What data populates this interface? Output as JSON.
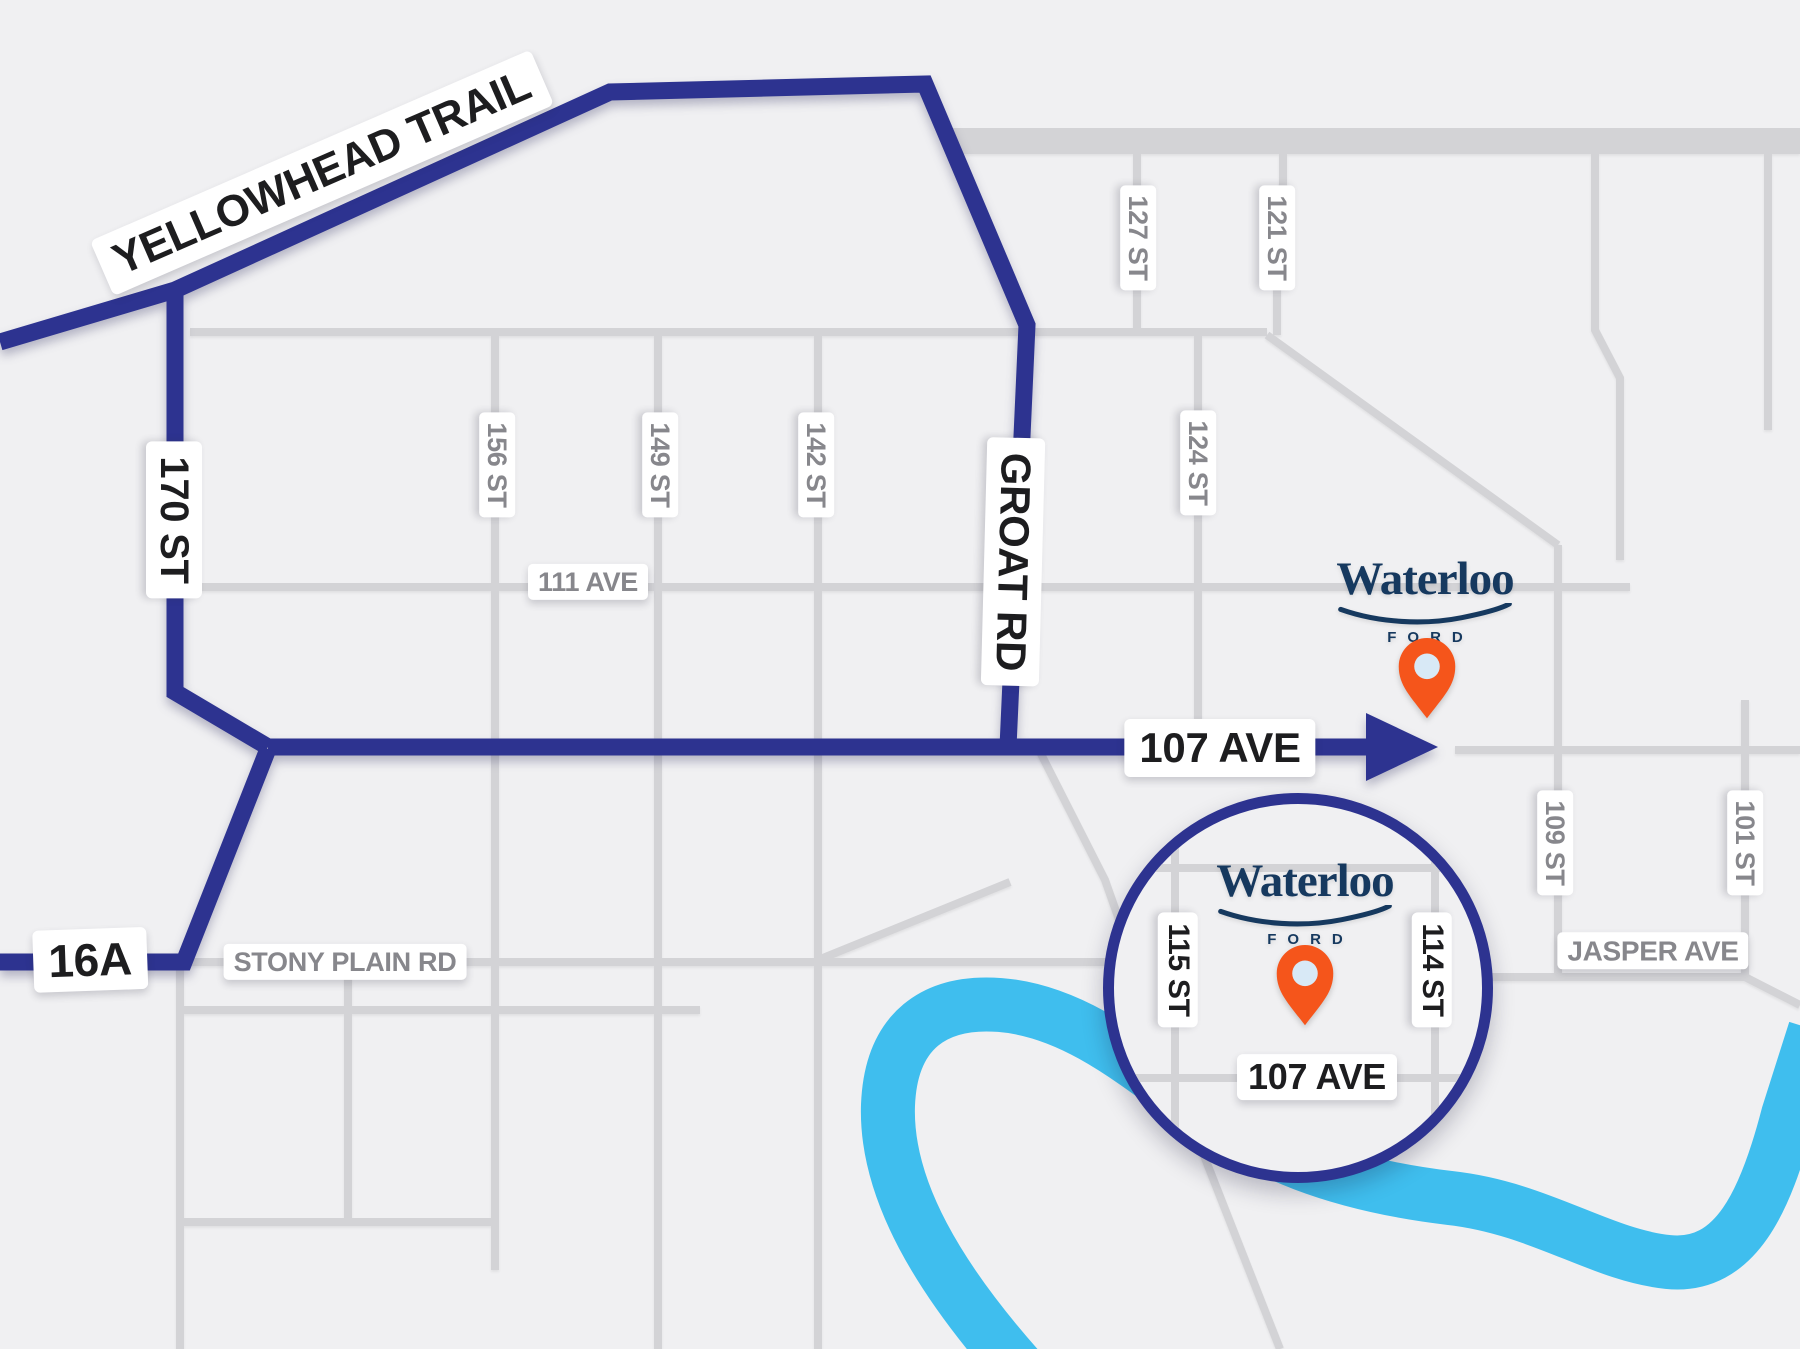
{
  "map_title": "Waterloo Ford location map",
  "roads": {
    "yellowhead_trail": "YELLOWHEAD TRAIL",
    "st_170": "170 ST",
    "groat_rd": "GROAT RD",
    "ave_107": "107 AVE",
    "hwy_16a": "16A",
    "stony_plain_rd": "STONY PLAIN RD",
    "ave_111": "111 AVE",
    "st_156": "156 ST",
    "st_149": "149 ST",
    "st_142": "142 ST",
    "st_127": "127 ST",
    "st_124": "124 ST",
    "st_121": "121 ST",
    "st_109": "109 ST",
    "st_101": "101 ST",
    "jasper_ave": "JASPER AVE"
  },
  "inset": {
    "st_115": "115 ST",
    "st_114": "114 ST",
    "ave_107": "107 AVE"
  },
  "logo": {
    "name": "Waterloo",
    "division": "FORD"
  },
  "icons": {
    "destination_pin": "map-pin-icon",
    "logo_swoosh": "swoosh-underline-icon",
    "route_arrow": "arrow-right-icon"
  },
  "colors": {
    "background": "#f0f0f2",
    "road_gray": "#d3d3d6",
    "route_navy": "#2d3390",
    "river_blue": "#3fbeee",
    "label_gray": "#87878c",
    "label_black": "#1d1d1f",
    "logo_navy": "#16395f",
    "pin_orange": "#f5551b",
    "pin_inner_blue": "#d8e9f6"
  }
}
